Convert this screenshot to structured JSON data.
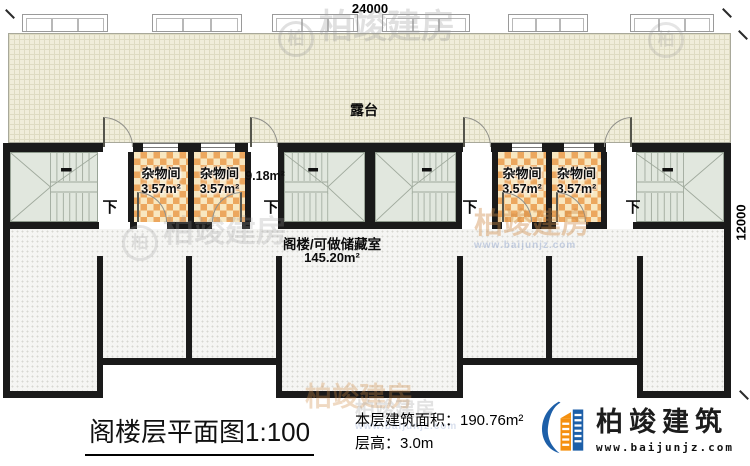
{
  "colors": {
    "wall": "#1a1a1a",
    "terrace_floor": "#f0edda",
    "attic_floor": "#f5f5f3",
    "room_checker_orange": "#eca75e",
    "room_checker_cream": "#f8e7c0",
    "stair_fill": "#e1e7de",
    "brand_blue": "#1d5fa8",
    "brand_orange": "#f5900f"
  },
  "dimensions": {
    "top": "24000",
    "right": "12000"
  },
  "terrace": {
    "label": "露台"
  },
  "corridor": {
    "area": "9.18m²"
  },
  "stairs": {
    "down_label": "下"
  },
  "rooms": [
    {
      "name": "杂物间",
      "area": "3.57m²"
    },
    {
      "name": "杂物间",
      "area": "3.57m²"
    },
    {
      "name": "杂物间",
      "area": "3.57m²"
    },
    {
      "name": "杂物间",
      "area": "3.57m²"
    }
  ],
  "attic": {
    "name": "阁楼/可做储藏室",
    "area": "145.20m²"
  },
  "title": {
    "name": "阁楼层平面图",
    "scale": "1:100"
  },
  "stats": {
    "area": "本层建筑面积：190.76m²",
    "height": "层高：3.0m"
  },
  "brand": {
    "name": "柏竣建筑",
    "url": "www.baijunjz.com"
  },
  "watermark": {
    "text": "柏竣建房",
    "short": "柏",
    "url": "www.baijunjz.com"
  }
}
